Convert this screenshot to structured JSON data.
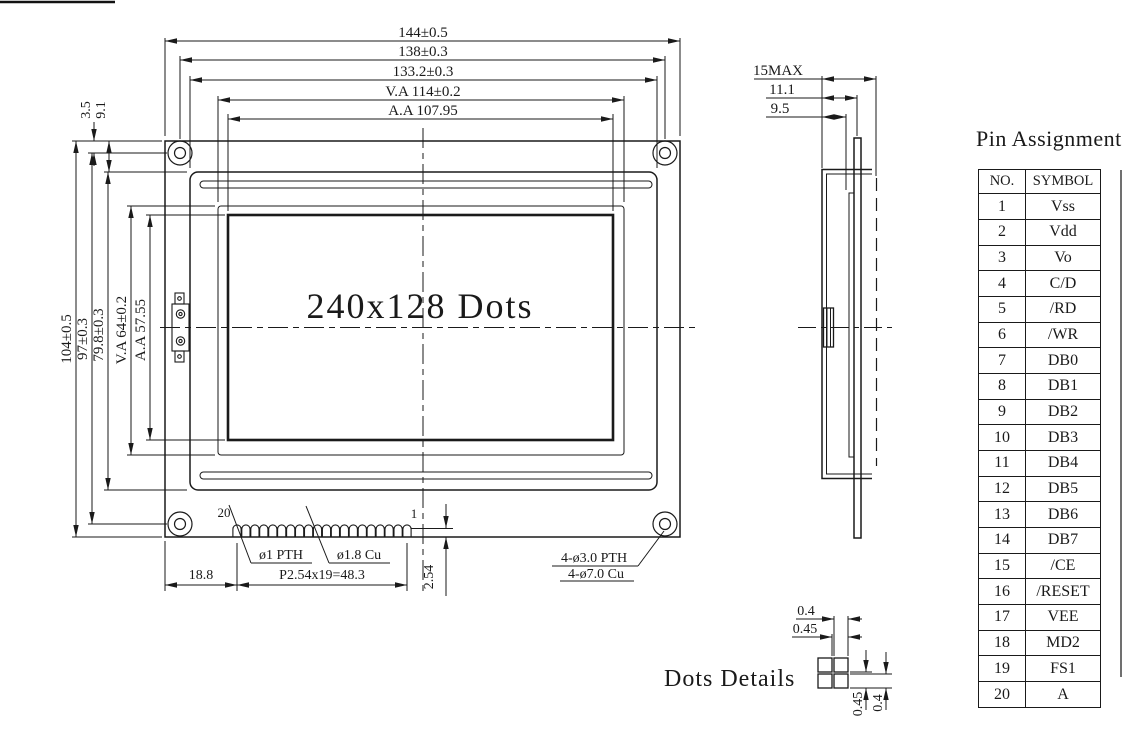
{
  "drawing": {
    "colors": {
      "line": "#1a1a1a",
      "background": "#ffffff"
    },
    "front_view": {
      "display_area_label": "240x128 Dots",
      "horizontal_dims": [
        "144±0.5",
        "138±0.3",
        "133.2±0.3",
        "V.A 114±0.2",
        "A.A 107.95"
      ],
      "vertical_dims": [
        "104±0.5",
        "97±0.3",
        "79.8±0.3",
        "V.A 64±0.2",
        "A.A 57.55"
      ],
      "corner_offset_dims": [
        "3.5",
        "9.1"
      ],
      "pin_number_labels": [
        "20",
        "1"
      ],
      "pin_hole_notes": [
        "ø1 PTH",
        "ø1.8 Cu"
      ],
      "mounting_hole_notes": [
        "4-ø3.0 PTH",
        "4-ø7.0 Cu"
      ],
      "bottom_dims": [
        "18.8",
        "P2.54x19=48.3",
        "2.54"
      ]
    },
    "side_view": {
      "thickness_dims": [
        "15MAX",
        "11.1",
        "9.5"
      ]
    },
    "dots_details": {
      "label": "Dots Details",
      "horizontal_dims": [
        "0.4",
        "0.45"
      ],
      "vertical_dims": [
        "0.45",
        "0.4"
      ]
    },
    "pin_assignment": {
      "title": "Pin Assignment",
      "headers": [
        "NO.",
        "SYMBOL"
      ],
      "rows": [
        [
          "1",
          "Vss"
        ],
        [
          "2",
          "Vdd"
        ],
        [
          "3",
          "Vo"
        ],
        [
          "4",
          "C/D"
        ],
        [
          "5",
          "/RD"
        ],
        [
          "6",
          "/WR"
        ],
        [
          "7",
          "DB0"
        ],
        [
          "8",
          "DB1"
        ],
        [
          "9",
          "DB2"
        ],
        [
          "10",
          "DB3"
        ],
        [
          "11",
          "DB4"
        ],
        [
          "12",
          "DB5"
        ],
        [
          "13",
          "DB6"
        ],
        [
          "14",
          "DB7"
        ],
        [
          "15",
          "/CE"
        ],
        [
          "16",
          "/RESET"
        ],
        [
          "17",
          "VEE"
        ],
        [
          "18",
          "MD2"
        ],
        [
          "19",
          "FS1"
        ],
        [
          "20",
          "A"
        ]
      ]
    }
  }
}
